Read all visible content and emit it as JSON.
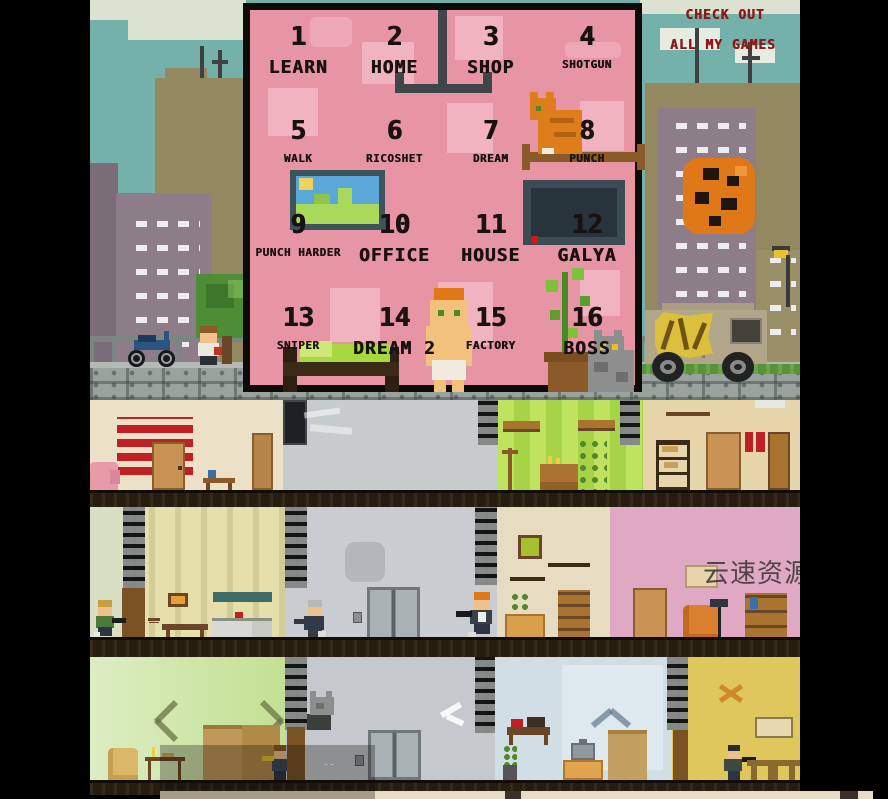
{
  "promo": {
    "line1": "CHECK OUT",
    "line2": "ALL MY GAMES"
  },
  "menu": {
    "levels": [
      {
        "num": "1",
        "label": "LEARN"
      },
      {
        "num": "2",
        "label": "HOME"
      },
      {
        "num": "3",
        "label": "SHOP"
      },
      {
        "num": "4",
        "label": "SHOTGUN"
      },
      {
        "num": "5",
        "label": "WALK"
      },
      {
        "num": "6",
        "label": "RICOSHET"
      },
      {
        "num": "7",
        "label": "DREAM"
      },
      {
        "num": "8",
        "label": "PUNCH"
      },
      {
        "num": "9",
        "label": "PUNCH HARDER"
      },
      {
        "num": "10",
        "label": "OFFICE"
      },
      {
        "num": "11",
        "label": "HOUSE"
      },
      {
        "num": "12",
        "label": "GALYA"
      },
      {
        "num": "13",
        "label": "SNIPER"
      },
      {
        "num": "14",
        "label": "DREAM 2"
      },
      {
        "num": "15",
        "label": "FACTORY"
      },
      {
        "num": "16",
        "label": "BOSS"
      }
    ]
  },
  "watermark": {
    "text": "云速资源网"
  },
  "colors": {
    "panel_pink": "#e795a4",
    "panel_square_pink": "#f0b3bf",
    "promo_red": "#8e1717",
    "sky_teal": "#74b1ab",
    "level_text": "#191210"
  }
}
